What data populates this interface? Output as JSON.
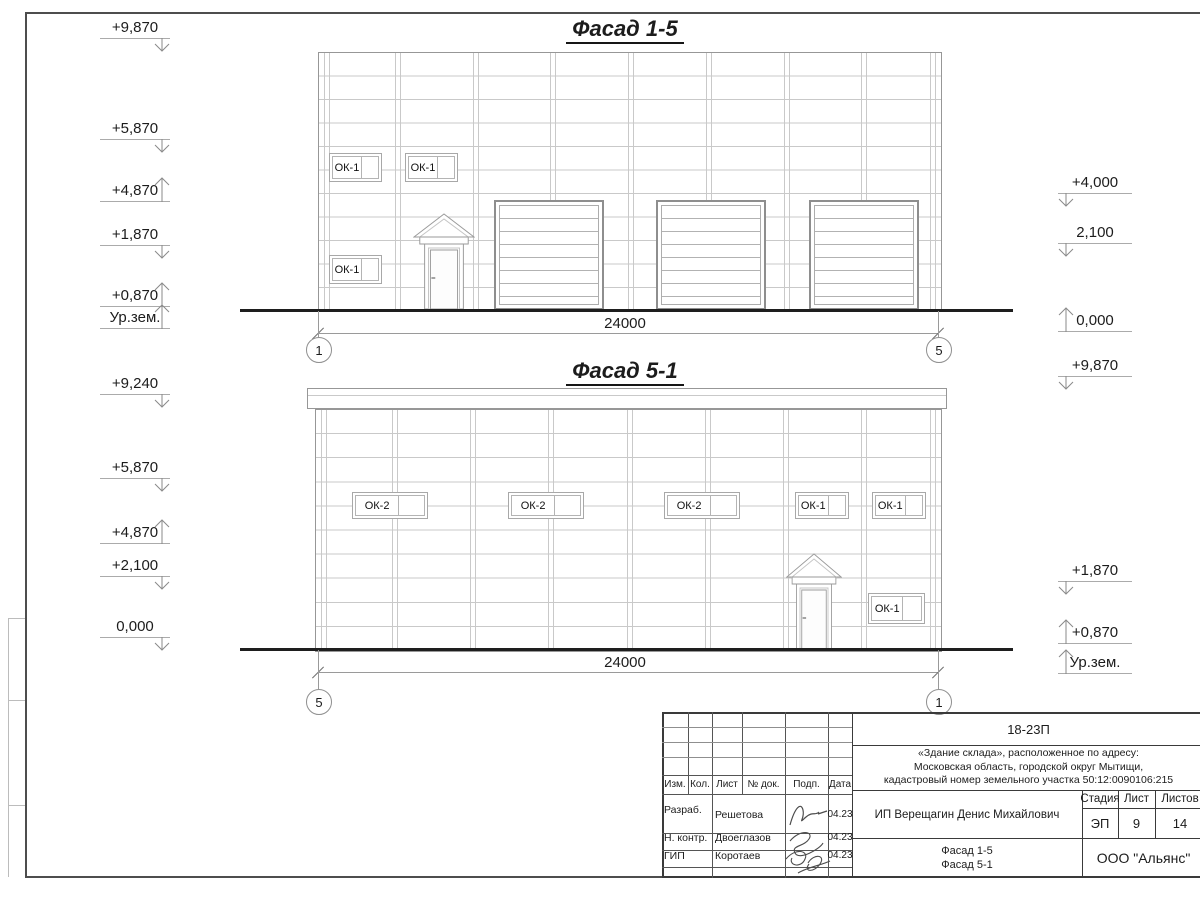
{
  "drawing": {
    "facade1": {
      "title": "Фасад 1-5",
      "dimension_label": "24000",
      "axis_left": "1",
      "axis_right": "5",
      "marks_left": [
        {
          "text": "+9,870",
          "y": 38,
          "dir": "down"
        },
        {
          "text": "+5,870",
          "y": 139,
          "dir": "down"
        },
        {
          "text": "+4,870",
          "y": 201,
          "dir": "up"
        },
        {
          "text": "+1,870",
          "y": 245,
          "dir": "down"
        },
        {
          "text": "+0,870",
          "y": 306,
          "dir": "up"
        },
        {
          "text": "Ур.зем.",
          "y": 328,
          "dir": "up"
        }
      ],
      "marks_right": [
        {
          "text": "+4,000",
          "y": 193,
          "dir": "down"
        },
        {
          "text": "2,100",
          "y": 243,
          "dir": "down"
        },
        {
          "text": "0,000",
          "y": 331,
          "dir": "up"
        }
      ],
      "windows": [
        {
          "label": "ОК-1",
          "x": 329,
          "y": 153,
          "w": 53,
          "h": 29
        },
        {
          "label": "ОК-1",
          "x": 405,
          "y": 153,
          "w": 53,
          "h": 29
        },
        {
          "label": "ОК-1",
          "x": 329,
          "y": 255,
          "w": 53,
          "h": 29
        }
      ],
      "gates": [
        {
          "x": 494,
          "y": 200,
          "w": 110,
          "h": 110
        },
        {
          "x": 656,
          "y": 200,
          "w": 110,
          "h": 110
        },
        {
          "x": 809,
          "y": 200,
          "w": 110,
          "h": 110
        }
      ],
      "door": {
        "x": 413,
        "y": 212,
        "w": 62,
        "h": 98
      }
    },
    "facade2": {
      "title": "Фасад 5-1",
      "dimension_label": "24000",
      "axis_left": "5",
      "axis_right": "1",
      "marks_left": [
        {
          "text": "+9,240",
          "y": 394,
          "dir": "down"
        },
        {
          "text": "+5,870",
          "y": 478,
          "dir": "down"
        },
        {
          "text": "+4,870",
          "y": 543,
          "dir": "up"
        },
        {
          "text": "+2,100",
          "y": 576,
          "dir": "down"
        },
        {
          "text": "0,000",
          "y": 637,
          "dir": "down"
        }
      ],
      "marks_right": [
        {
          "text": "+9,870",
          "y": 376,
          "dir": "down"
        },
        {
          "text": "+1,870",
          "y": 581,
          "dir": "down"
        },
        {
          "text": "+0,870",
          "y": 643,
          "dir": "up"
        },
        {
          "text": "Ур.зем.",
          "y": 673,
          "dir": "up"
        }
      ],
      "windows": [
        {
          "label": "ОК-2",
          "x": 352,
          "y": 492,
          "w": 76,
          "h": 27
        },
        {
          "label": "ОК-2",
          "x": 508,
          "y": 492,
          "w": 76,
          "h": 27
        },
        {
          "label": "ОК-2",
          "x": 664,
          "y": 492,
          "w": 76,
          "h": 27
        },
        {
          "label": "ОК-1",
          "x": 795,
          "y": 492,
          "w": 54,
          "h": 27
        },
        {
          "label": "ОК-1",
          "x": 872,
          "y": 492,
          "w": 54,
          "h": 27
        },
        {
          "label": "ОК-1",
          "x": 868,
          "y": 593,
          "w": 57,
          "h": 31
        }
      ],
      "gates": [],
      "door": {
        "x": 786,
        "y": 552,
        "w": 56,
        "h": 98
      }
    }
  },
  "titleblock": {
    "code": "18-23П",
    "address_lines": [
      "«Здание склада», расположенное по адресу:",
      "Московская область, городской округ Мытищи,",
      "кадастровый номер земельного участка 50:12:0090106:215"
    ],
    "client": "ИП Верещагин Денис Михайлович",
    "stage_label": "Стадия",
    "sheet_label": "Лист",
    "sheets_label": "Листов",
    "stage": "ЭП",
    "sheet_no": "9",
    "sheets_total": "14",
    "doc_titles": [
      "Фасад 1-5",
      "Фасад 5-1"
    ],
    "company": "ООО \"Альянс\"",
    "header_cols": [
      "Изм.",
      "Кол.",
      "Лист",
      "№ док.",
      "Подп.",
      "Дата"
    ],
    "staff": [
      {
        "role": "Разраб.",
        "name": "Решетова",
        "date": "04.23"
      },
      {
        "role": "Н. контр.",
        "name": "Двоеглазов",
        "date": "04.23"
      },
      {
        "role": "ГИП",
        "name": "Коротаев",
        "date": "04.23"
      }
    ]
  }
}
